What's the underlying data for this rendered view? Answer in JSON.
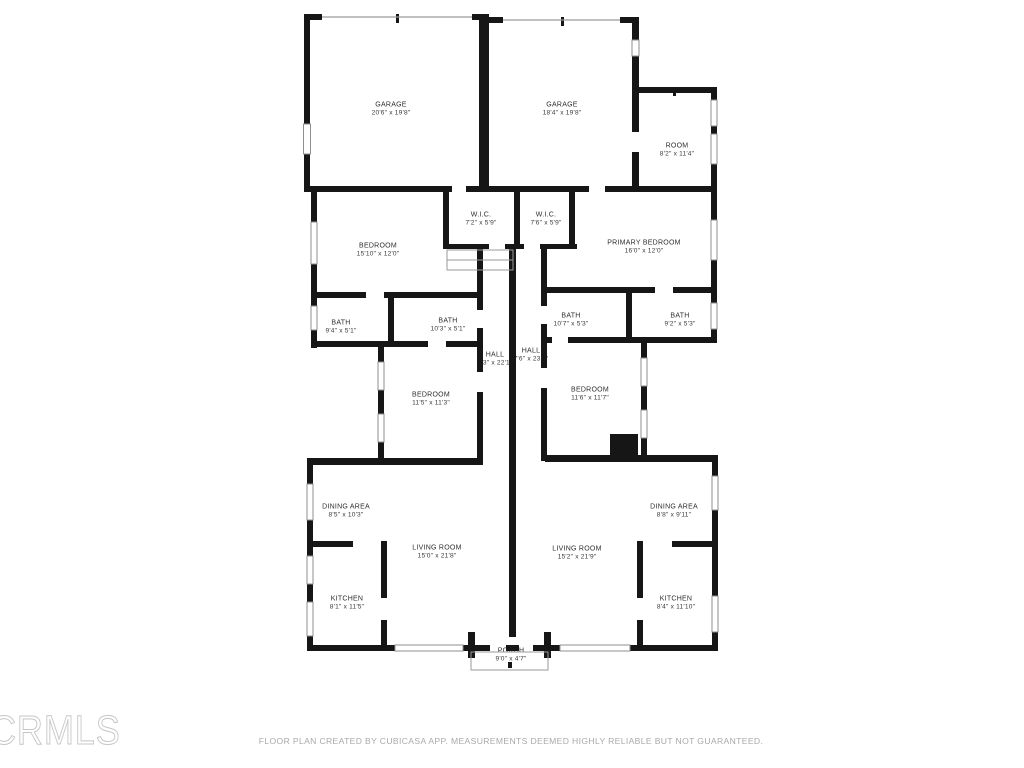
{
  "watermark": "CRMLS",
  "footer": "FLOOR PLAN CREATED BY CUBICASA APP. MEASUREMENTS DEEMED HIGHLY RELIABLE BUT NOT GUARANTEED.",
  "colors": {
    "wall": "#161616",
    "window_line": "#8f8f8f",
    "label_text": "#2e2e2e",
    "footer_text": "#a9a9a9",
    "watermark_outline": "#c6c6c6",
    "background": "#ffffff"
  },
  "rooms": {
    "garage_left": {
      "name": "GARAGE",
      "dims": "20'6\" x 19'8\""
    },
    "garage_right": {
      "name": "GARAGE",
      "dims": "18'4\" x 19'8\""
    },
    "room_top_right": {
      "name": "ROOM",
      "dims": "8'2\" x 11'4\""
    },
    "bedroom_left": {
      "name": "BEDROOM",
      "dims": "15'10\" x 12'0\""
    },
    "wic_left": {
      "name": "W.I.C.",
      "dims": "7'2\" x 5'9\""
    },
    "wic_right": {
      "name": "W.I.C.",
      "dims": "7'6\" x 5'9\""
    },
    "primary_bedroom": {
      "name": "PRIMARY BEDROOM",
      "dims": "16'0\" x 12'0\""
    },
    "bath_1": {
      "name": "BATH",
      "dims": "9'4\" x 5'1\""
    },
    "bath_2": {
      "name": "BATH",
      "dims": "10'3\" x 5'1\""
    },
    "bath_3": {
      "name": "BATH",
      "dims": "10'7\" x 5'3\""
    },
    "bath_4": {
      "name": "BATH",
      "dims": "9'2\" x 5'3\""
    },
    "hall_left": {
      "name": "HALL",
      "dims": "3'3\" x 22'1\""
    },
    "hall_right": {
      "name": "HALL",
      "dims": "7'6\" x 23'1\""
    },
    "bedroom_mid_left": {
      "name": "BEDROOM",
      "dims": "11'5\" x 11'3\""
    },
    "bedroom_mid_right": {
      "name": "BEDROOM",
      "dims": "11'6\" x 11'7\""
    },
    "dining_left": {
      "name": "DINING AREA",
      "dims": "8'5\" x 10'3\""
    },
    "dining_right": {
      "name": "DINING AREA",
      "dims": "8'8\" x 9'11\""
    },
    "living_left": {
      "name": "LIVING ROOM",
      "dims": "15'0\" x 21'8\""
    },
    "living_right": {
      "name": "LIVING ROOM",
      "dims": "15'2\" x 21'9\""
    },
    "kitchen_left": {
      "name": "KITCHEN",
      "dims": "8'1\" x 11'5\""
    },
    "kitchen_right": {
      "name": "KITCHEN",
      "dims": "8'4\" x 11'10\""
    },
    "porch": {
      "name": "PORCH",
      "dims": "9'0\" x 4'7\""
    }
  }
}
